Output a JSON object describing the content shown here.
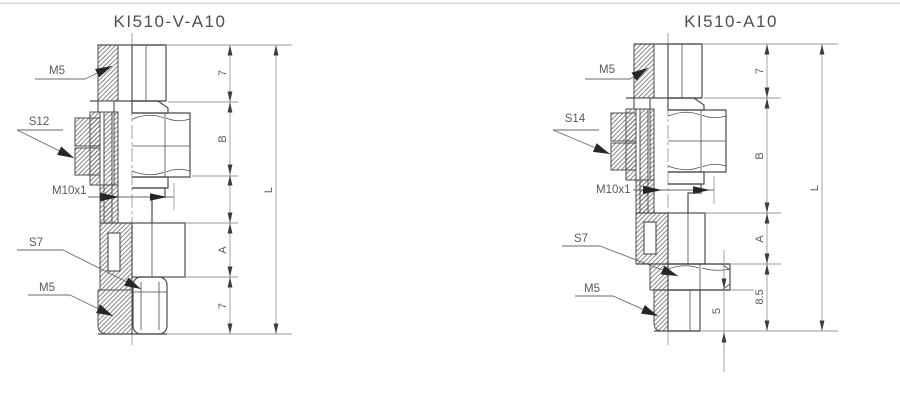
{
  "colors": {
    "background": "#ffffff",
    "part_outline": "#4c4c4c",
    "hatch_lines": "#6a6a6a",
    "dimension_lines": "#9a9a9a",
    "arrows": "#262626",
    "label_text": "#5a5a5a",
    "top_border": "#d8d8d8"
  },
  "drawings": [
    {
      "title": "KI510-V-A10",
      "callouts": {
        "thread_top": "M5",
        "hex_upper": "S12",
        "thread_mid": "M10x1",
        "hex_lower": "S7",
        "thread_bottom": "M5"
      },
      "dims": {
        "top_height": "7",
        "hex_height": "B",
        "body_height": "A",
        "bottom_height": "7",
        "overall_length": "L"
      }
    },
    {
      "title": "KI510-A10",
      "callouts": {
        "thread_top": "M5",
        "hex_upper": "S14",
        "thread_mid": "M10x1",
        "hex_lower": "S7",
        "thread_bottom": "M5"
      },
      "dims": {
        "top_height": "7",
        "hex_height": "B",
        "body_height": "A",
        "bottom_height": "8.5",
        "stem_height": "5",
        "overall_length": "L"
      }
    }
  ]
}
